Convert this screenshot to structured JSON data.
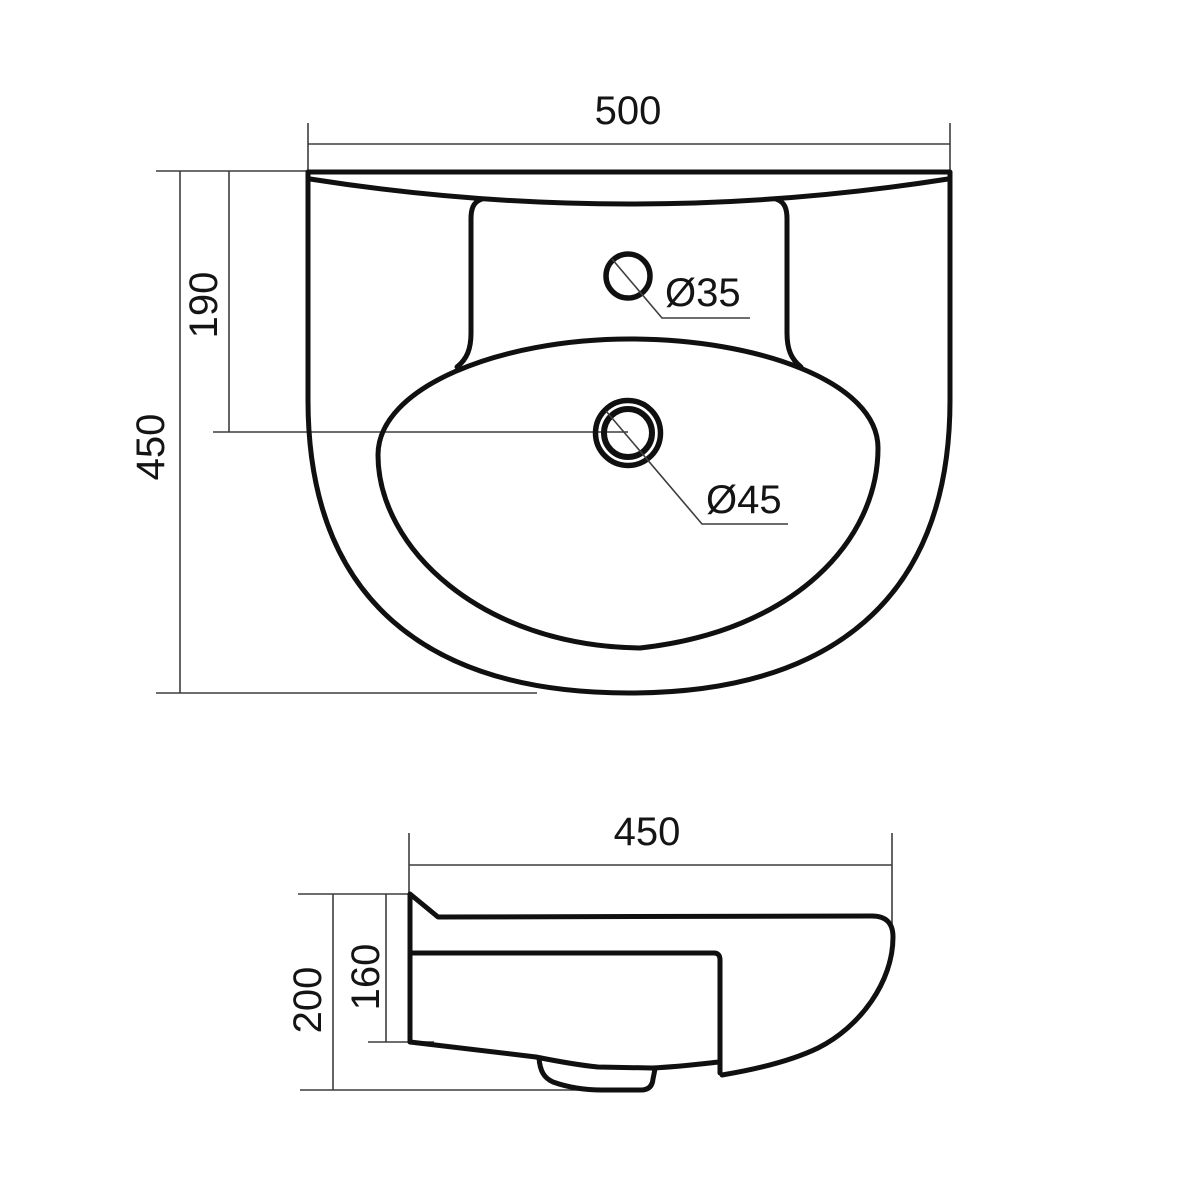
{
  "colors": {
    "background": "#ffffff",
    "outline": "#101010",
    "dimension_lines": "#3d3d3d",
    "text": "#141414"
  },
  "top_view": {
    "width_label": "500",
    "height_label": "450",
    "drain_offset_label": "190",
    "tap_hole_diameter_label": "Ø35",
    "drain_diameter_label": "Ø45"
  },
  "side_view": {
    "depth_label": "450",
    "overall_height_label": "200",
    "back_height_label": "160"
  }
}
